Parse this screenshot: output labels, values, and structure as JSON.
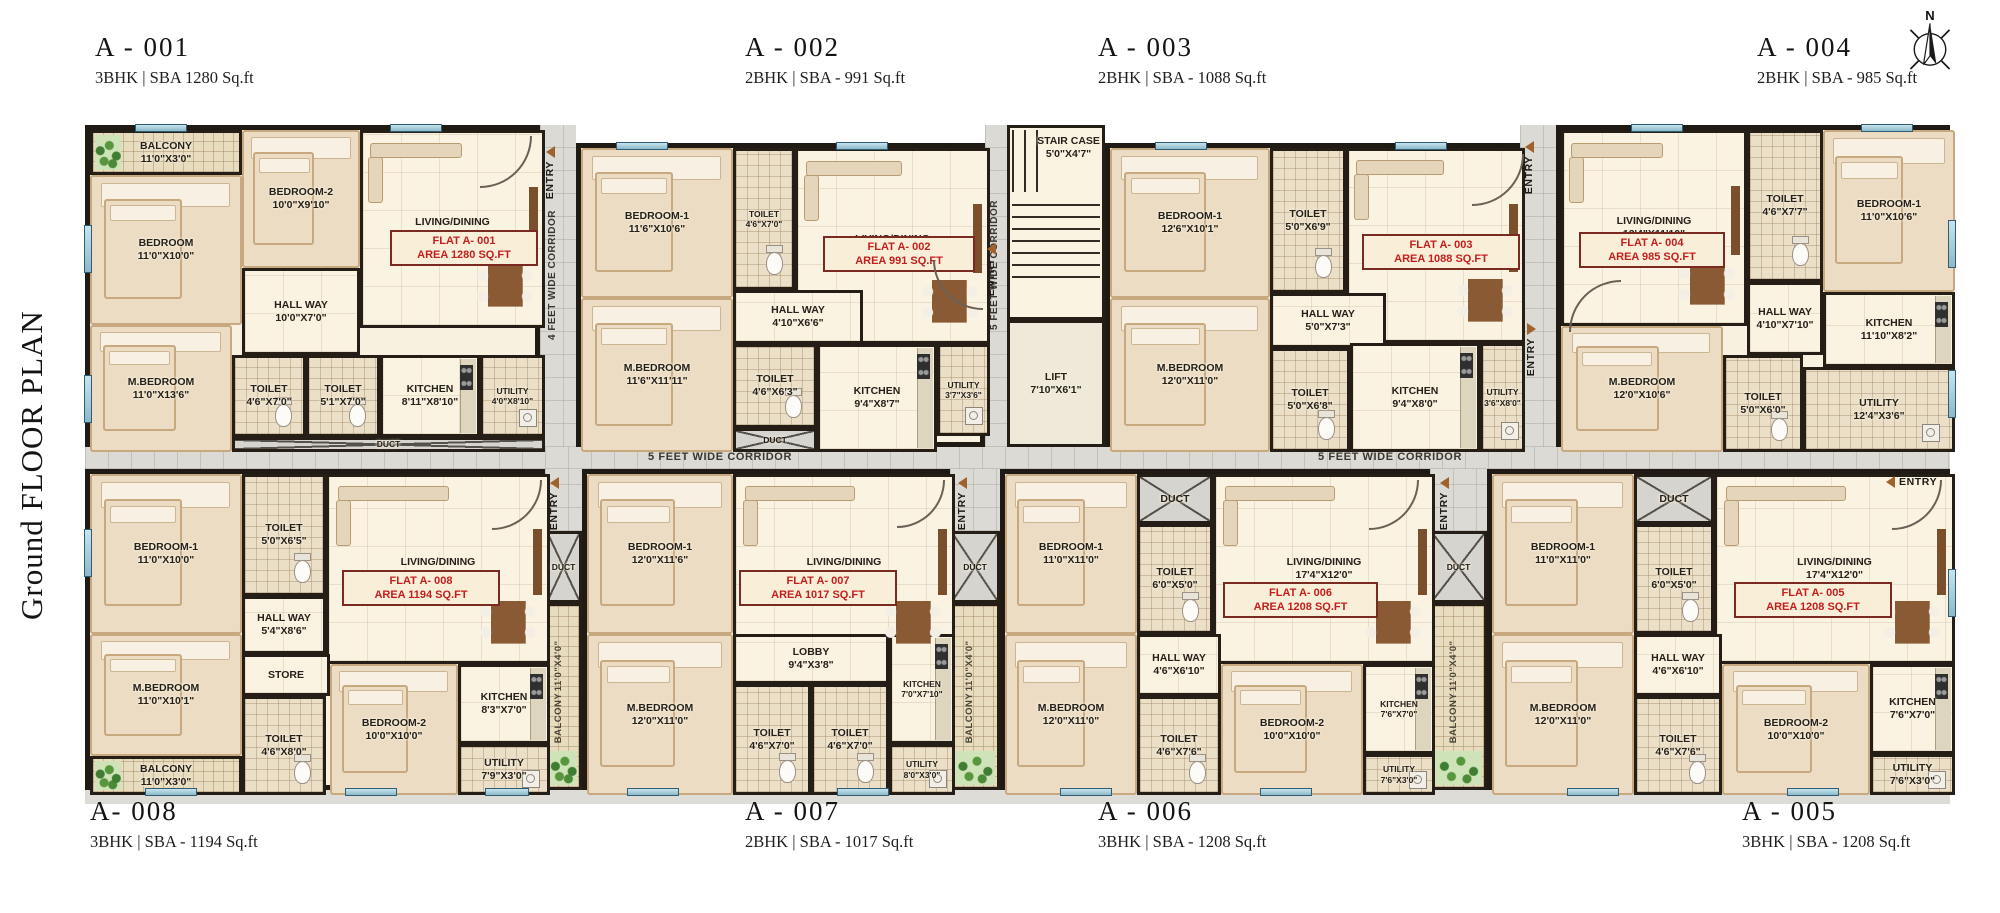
{
  "title": "Ground FLOOR PLAN",
  "compass": "N",
  "labels": {
    "entry": "ENTRY",
    "duct": "DUCT"
  },
  "corridors": {
    "v4": "4 FEET WIDE CORRIDOR",
    "v5": "5 FEET WIDE CORRIDOR",
    "h1": "5 FEET WIDE CORRIDOR",
    "h2": "5 FEET WIDE CORRIDOR"
  },
  "core": {
    "stair_name": "STAIR CASE",
    "stair_dims": "5'0\"X4'7\"",
    "lift_name": "LIFT",
    "lift_dims": "7'10\"X6'1\""
  },
  "strips": [
    {
      "name": "BALCONY",
      "dims": "11'0\"X4'0\""
    },
    {
      "name": "BALCONY",
      "dims": "11'0\"X4'0\""
    },
    {
      "name": "BALCONY",
      "dims": "11'0\"X4'0\""
    }
  ],
  "units": [
    {
      "id": "A - 001",
      "spec": "3BHK | SBA 1280 Sq.ft",
      "flat_label": "FLAT A- 001",
      "area_label": "AREA 1280 SQ.FT",
      "rooms": [
        {
          "name": "BALCONY",
          "dims": "11'0\"X3'0\""
        },
        {
          "name": "BEDROOM",
          "dims": "11'0\"X10'0\""
        },
        {
          "name": "BEDROOM-2",
          "dims": "10'0\"X9'10\""
        },
        {
          "name": "LIVING/DINING",
          "dims": "13'1\"X15'4\""
        },
        {
          "name": "HALL WAY",
          "dims": "10'0\"X7'0\""
        },
        {
          "name": "M.BEDROOM",
          "dims": "11'0\"X13'6\""
        },
        {
          "name": "TOILET",
          "dims": "4'6\"X7'0\""
        },
        {
          "name": "TOILET",
          "dims": "5'1\"X7'0\""
        },
        {
          "name": "KITCHEN",
          "dims": "8'11\"X8'10\""
        },
        {
          "name": "UTILITY",
          "dims": "4'0\"X8'10\""
        },
        {
          "name": "DUCT"
        }
      ]
    },
    {
      "id": "A - 002",
      "spec": "2BHK | SBA - 991 Sq.ft",
      "flat_label": "FLAT A- 002",
      "area_label": "AREA 991 SQ.FT",
      "rooms": [
        {
          "name": "BEDROOM-1",
          "dims": "11'6\"X10'6\""
        },
        {
          "name": "TOILET",
          "dims": "4'6\"X7'0\""
        },
        {
          "name": "LIVING/DINING",
          "dims": "13'0\"X13'10\""
        },
        {
          "name": "HALL WAY",
          "dims": "4'10\"X6'6\""
        },
        {
          "name": "M.BEDROOM",
          "dims": "11'6\"X11'11\""
        },
        {
          "name": "TOILET",
          "dims": "4'6\"X6'3\""
        },
        {
          "name": "KITCHEN",
          "dims": "9'4\"X8'7\""
        },
        {
          "name": "UTILITY",
          "dims": "3'7\"X3'6\""
        },
        {
          "name": "DUCT"
        }
      ]
    },
    {
      "id": "A - 003",
      "spec": "2BHK | SBA - 1088 Sq.ft",
      "flat_label": "FLAT A- 003",
      "area_label": "AREA 1088 SQ.FT",
      "rooms": [
        {
          "name": "BEDROOM-1",
          "dims": "12'6\"X10'1\""
        },
        {
          "name": "TOILET",
          "dims": "5'0\"X6'9\""
        },
        {
          "name": "LIVING/DINING",
          "dims": "13'0\"X14'5\""
        },
        {
          "name": "HALL WAY",
          "dims": "5'0\"X7'3\""
        },
        {
          "name": "M.BEDROOM",
          "dims": "12'0\"X11'0\""
        },
        {
          "name": "TOILET",
          "dims": "5'0\"X6'8\""
        },
        {
          "name": "KITCHEN",
          "dims": "9'4\"X8'0\""
        },
        {
          "name": "UTILITY",
          "dims": "3'6\"X8'0\""
        }
      ]
    },
    {
      "id": "A - 004",
      "spec": "2BHK | SBA - 985 Sq.ft",
      "flat_label": "FLAT A- 004",
      "area_label": "AREA 985 SQ.FT",
      "rooms": [
        {
          "name": "LIVING/DINING",
          "dims": "13'4\"X11'10\""
        },
        {
          "name": "TOILET",
          "dims": "4'6\"X7'7\""
        },
        {
          "name": "BEDROOM-1",
          "dims": "11'0\"X10'6\""
        },
        {
          "name": "HALL WAY",
          "dims": "4'10\"X7'10\""
        },
        {
          "name": "M.BEDROOM",
          "dims": "12'0\"X10'6\""
        },
        {
          "name": "TOILET",
          "dims": "5'0\"X6'0\""
        },
        {
          "name": "KITCHEN",
          "dims": "11'10\"X8'2\""
        },
        {
          "name": "UTILITY",
          "dims": "12'4\"X3'6\""
        }
      ]
    },
    {
      "id": "A- 008",
      "spec": "3BHK | SBA - 1194 Sq.ft",
      "flat_label": "FLAT A- 008",
      "area_label": "AREA 1194 SQ.FT",
      "rooms": [
        {
          "name": "BEDROOM-1",
          "dims": "11'0\"X10'0\""
        },
        {
          "name": "TOILET",
          "dims": "5'0\"X6'5\""
        },
        {
          "name": "LIVING/DINING",
          "dims": "18'1\"X13'3\""
        },
        {
          "name": "HALL WAY",
          "dims": "5'4\"X8'6\""
        },
        {
          "name": "M.BEDROOM",
          "dims": "11'0\"X10'1\""
        },
        {
          "name": "STORE"
        },
        {
          "name": "TOILET",
          "dims": "4'6\"X8'0\""
        },
        {
          "name": "BEDROOM-2",
          "dims": "10'0\"X10'0\""
        },
        {
          "name": "KITCHEN",
          "dims": "8'3\"X7'0\""
        },
        {
          "name": "UTILITY",
          "dims": "7'9\"X3'0\""
        },
        {
          "name": "BALCONY",
          "dims": "11'0\"X3'0\""
        }
      ]
    },
    {
      "id": "A - 007",
      "spec": "2BHK | SBA - 1017 Sq.ft",
      "flat_label": "FLAT A- 007",
      "area_label": "AREA 1017 SQ.FT",
      "rooms": [
        {
          "name": "BEDROOM-1",
          "dims": "12'0\"X11'6\""
        },
        {
          "name": "LIVING/DINING",
          "dims": "16'9\"X11'0\""
        },
        {
          "name": "LOBBY",
          "dims": "9'4\"X3'8\""
        },
        {
          "name": "M.BEDROOM",
          "dims": "12'0\"X11'0\""
        },
        {
          "name": "TOILET",
          "dims": "4'6\"X7'0\""
        },
        {
          "name": "TOILET",
          "dims": "4'6\"X7'0\""
        },
        {
          "name": "KITCHEN",
          "dims": "7'0\"X7'10\""
        },
        {
          "name": "UTILITY",
          "dims": "8'0\"X3'0\""
        }
      ]
    },
    {
      "id": "A - 006",
      "spec": "3BHK | SBA - 1208 Sq.ft",
      "flat_label": "FLAT A- 006",
      "area_label": "AREA 1208 SQ.FT",
      "rooms": [
        {
          "name": "BEDROOM-1",
          "dims": "11'0\"X11'0\""
        },
        {
          "name": "DUCT"
        },
        {
          "name": "TOILET",
          "dims": "6'0\"X5'0\""
        },
        {
          "name": "LIVING/DINING",
          "dims": "17'4\"X12'0\""
        },
        {
          "name": "HALL WAY",
          "dims": "4'6\"X6'10\""
        },
        {
          "name": "M.BEDROOM",
          "dims": "12'0\"X11'0\""
        },
        {
          "name": "TOILET",
          "dims": "4'6\"X7'6\""
        },
        {
          "name": "BEDROOM-2",
          "dims": "10'0\"X10'0\""
        },
        {
          "name": "KITCHEN",
          "dims": "7'6\"X7'0\""
        },
        {
          "name": "UTILITY",
          "dims": "7'6\"X3'0\""
        }
      ]
    },
    {
      "id": "A - 005",
      "spec": "3BHK | SBA - 1208 Sq.ft",
      "flat_label": "FLAT A- 005",
      "area_label": "AREA 1208 SQ.FT",
      "rooms": [
        {
          "name": "BEDROOM-1",
          "dims": "11'0\"X11'0\""
        },
        {
          "name": "DUCT"
        },
        {
          "name": "TOILET",
          "dims": "6'0\"X5'0\""
        },
        {
          "name": "LIVING/DINING",
          "dims": "17'4\"X12'0\""
        },
        {
          "name": "HALL WAY",
          "dims": "4'6\"X6'10\""
        },
        {
          "name": "M.BEDROOM",
          "dims": "12'0\"X11'0\""
        },
        {
          "name": "TOILET",
          "dims": "4'6\"X7'6\""
        },
        {
          "name": "BEDROOM-2",
          "dims": "10'0\"X10'0\""
        },
        {
          "name": "KITCHEN",
          "dims": "7'6\"X7'0\""
        },
        {
          "name": "UTILITY",
          "dims": "7'6\"X3'0\""
        }
      ]
    }
  ]
}
